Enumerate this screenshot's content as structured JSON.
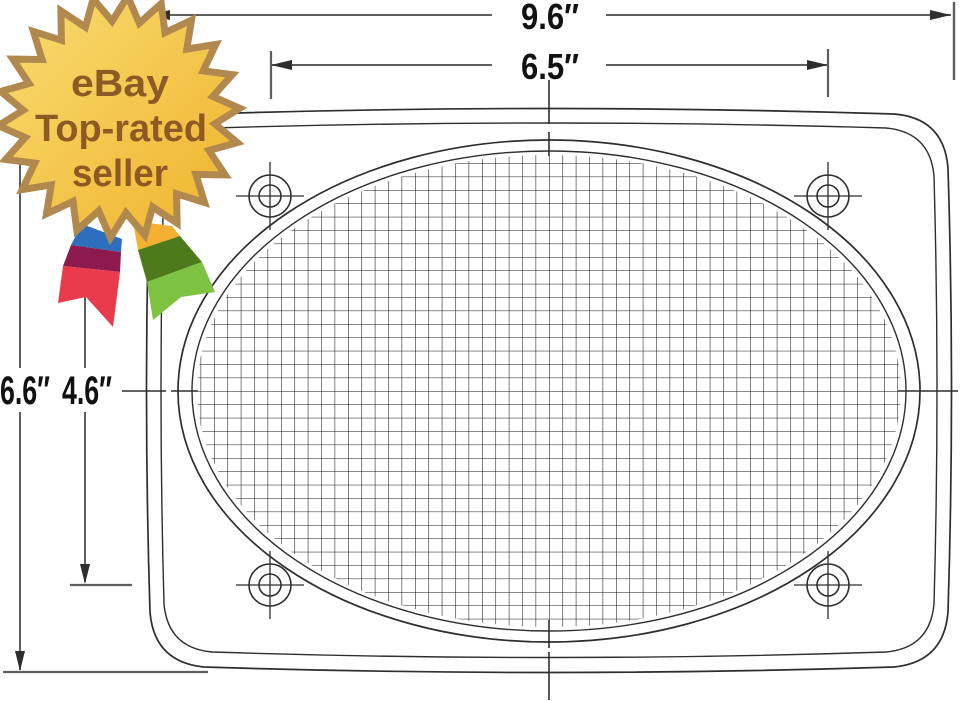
{
  "badge": {
    "line1": "eBay",
    "line2": "Top-rated",
    "line3": "seller"
  },
  "dimensions": {
    "overall_width": "9.6″",
    "hole_spacing_width": "6.5″",
    "overall_height": "6.6″",
    "hole_spacing_height": "4.6″"
  },
  "colors": {
    "badge_text": "#8d5a26",
    "star_light": "#f9dc72",
    "star_dark": "#efb32b",
    "star_border": "#b1894e",
    "ribbon_blue": "#2d6fbe",
    "ribbon_maroon": "#8c1a4e",
    "ribbon_red": "#e93b4b",
    "ribbon_yellow": "#f3b033",
    "ribbon_dark_green": "#4e7a1c",
    "ribbon_light_green": "#7ec242",
    "line_dark": "#2e2e2e",
    "line_dim": "#5f5f5f",
    "mesh_line": "#161616",
    "label_text": "#111111"
  }
}
